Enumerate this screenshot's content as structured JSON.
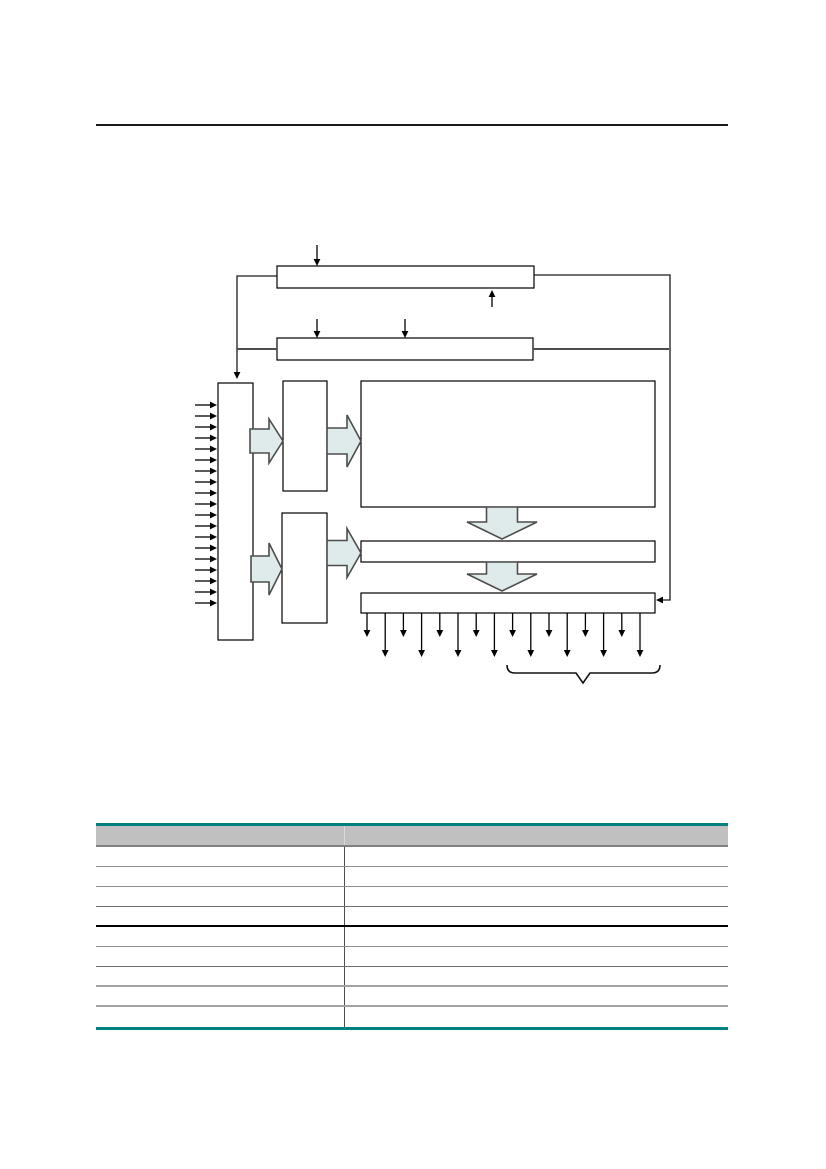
{
  "page": {
    "width": 826,
    "height": 1169,
    "background": "#ffffff",
    "top_rule": {
      "x": 96,
      "y": 124,
      "width": 632,
      "thickness": 2,
      "color": "#1a1a1a"
    }
  },
  "diagram": {
    "line_color": "#000000",
    "box_fill": "#ffffff",
    "block_arrow_fill": "#dfeaea",
    "block_arrow_stroke": "#4d4d4d",
    "boxes": [
      {
        "name": "diagram-box-top-register",
        "x": 277,
        "y": 266,
        "w": 257,
        "h": 22
      },
      {
        "name": "diagram-box-second-register",
        "x": 277,
        "y": 338,
        "w": 256,
        "h": 22
      },
      {
        "name": "diagram-box-input-column",
        "x": 218,
        "y": 383,
        "w": 35,
        "h": 257
      },
      {
        "name": "diagram-box-upper-small",
        "x": 283,
        "y": 381,
        "w": 44,
        "h": 110
      },
      {
        "name": "diagram-box-large-core",
        "x": 361,
        "y": 381,
        "w": 294,
        "h": 126
      },
      {
        "name": "diagram-box-lower-small",
        "x": 282,
        "y": 513,
        "w": 45,
        "h": 110
      },
      {
        "name": "diagram-box-wide-middle",
        "x": 361,
        "y": 541,
        "w": 294,
        "h": 21
      },
      {
        "name": "diagram-box-bottom-output",
        "x": 361,
        "y": 593,
        "w": 294,
        "h": 20
      }
    ],
    "connectors": [
      {
        "name": "connector-top-left-feedback",
        "points": "277,276 237,276 237,372",
        "arrow": "down",
        "stroke": "#1a1a1a",
        "width": 1.3
      },
      {
        "name": "connector-top-right-feedback",
        "points": "534,275 670,275 670,600 663,600",
        "arrow": "left",
        "stroke": "#1a1a1a",
        "width": 1.3
      },
      {
        "name": "connector-second-left-link",
        "points": "277,349 237,349",
        "arrow": null,
        "stroke": "#4d4d4d",
        "width": 2
      },
      {
        "name": "connector-second-right-link",
        "points": "533,349 669,349",
        "arrow": null,
        "stroke": "#4d4d4d",
        "width": 2
      }
    ],
    "vertical_arrows": [
      {
        "name": "arrow-into-top-register",
        "x": 317,
        "from": 245,
        "tip": 266
      },
      {
        "name": "arrow-up-into-top-register",
        "x": 492,
        "from": 307,
        "tip": 290
      },
      {
        "name": "arrow-into-second-register-1",
        "x": 317,
        "from": 319,
        "tip": 338
      },
      {
        "name": "arrow-into-second-register-2",
        "x": 405,
        "from": 319,
        "tip": 338
      }
    ],
    "input_arrows": {
      "count": 19,
      "x_from": 195,
      "x_tip": 217,
      "y_first": 405,
      "y_step": 11
    },
    "output_arrows": {
      "count": 16,
      "x_first": 367,
      "x_step": 18.2,
      "y_from": 613,
      "y_tip_short": 637,
      "y_tip_long": 657
    },
    "block_arrows": [
      {
        "name": "block-arrow-input-to-upper",
        "dir": "right",
        "x1": 250,
        "x2": 283,
        "cy": 441,
        "shaft": 24,
        "head": 44,
        "head_len": 14
      },
      {
        "name": "block-arrow-upper-to-core",
        "dir": "right",
        "x1": 327,
        "x2": 361,
        "cy": 441,
        "shaft": 26,
        "head": 52,
        "head_len": 14
      },
      {
        "name": "block-arrow-input-to-lower",
        "dir": "right",
        "x1": 251,
        "x2": 282,
        "cy": 569,
        "shaft": 26,
        "head": 52,
        "head_len": 13
      },
      {
        "name": "block-arrow-lower-to-middle",
        "dir": "right",
        "x1": 327,
        "x2": 361,
        "cy": 553,
        "shaft": 25,
        "head": 49,
        "head_len": 14
      },
      {
        "name": "block-arrow-core-to-middle",
        "dir": "down",
        "cx": 502,
        "y1": 507,
        "y2": 539,
        "shaft": 31,
        "head": 70,
        "head_len": 17
      },
      {
        "name": "block-arrow-middle-to-output",
        "dir": "down",
        "cx": 502,
        "y1": 562,
        "y2": 591,
        "shaft": 31,
        "head": 70,
        "head_len": 17
      }
    ],
    "brace": {
      "path": "M507,665 Q507,673 515,673 L576,673 L583,683 L590,673 L652,673 Q660,673 660,665",
      "color": "#111111"
    }
  },
  "table": {
    "x": 96,
    "y": 823,
    "width": 632,
    "accent_color": "#008080",
    "accent_thickness": 3,
    "header": {
      "height": 21,
      "bg": "#c0c0c0",
      "border_color": "#808080",
      "border_width": 2,
      "labels": [
        "",
        ""
      ]
    },
    "left_col_width": 249,
    "column_divider_color": "#4d4d4d",
    "header_divider_color": "#d9d9d9",
    "row_height": 20,
    "rows": [
      {
        "left": "",
        "right": ""
      },
      {
        "left": "",
        "right": ""
      },
      {
        "left": "",
        "right": ""
      },
      {
        "left": "",
        "right": ""
      },
      {
        "left": "",
        "right": ""
      },
      {
        "left": "",
        "right": ""
      },
      {
        "left": "",
        "right": ""
      },
      {
        "left": "",
        "right": ""
      },
      {
        "left": "",
        "right": ""
      }
    ],
    "row_border": [
      {
        "color": "#8f8f8f",
        "width": 1
      },
      {
        "color": "#8f8f8f",
        "width": 1
      },
      {
        "color": "#6e6e6e",
        "width": 1
      },
      {
        "color": "#000000",
        "width": 2
      },
      {
        "color": "#8f8f8f",
        "width": 1
      },
      {
        "color": "#6e6e6e",
        "width": 1
      },
      {
        "color": "#a3a3a3",
        "width": 2
      },
      {
        "color": "#a3a3a3",
        "width": 2
      },
      null
    ]
  }
}
